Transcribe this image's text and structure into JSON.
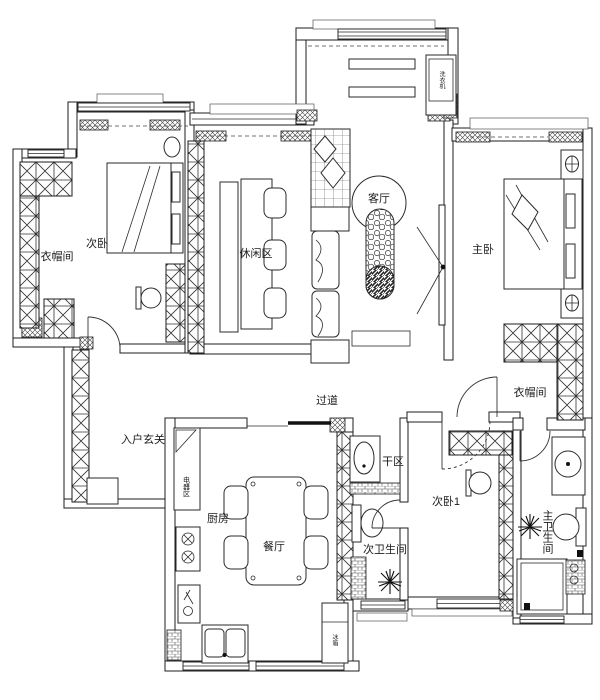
{
  "page": {
    "background": "#ffffff",
    "line_color": "#1c1c1c"
  },
  "rooms": {
    "cloakroom_left": {
      "label": "衣帽间"
    },
    "bedroom_2": {
      "label": "次卧"
    },
    "leisure_area": {
      "label": "休闲区"
    },
    "living_room": {
      "label": "客厅"
    },
    "master_bedroom": {
      "label": "主卧"
    },
    "cloakroom_right": {
      "label": "衣帽间"
    },
    "hallway": {
      "label": "过道"
    },
    "entry_foyer": {
      "label": "入户玄关"
    },
    "appliance_zone": {
      "label": "电器区"
    },
    "kitchen": {
      "label": "厨房"
    },
    "dining_room": {
      "label": "餐厅"
    },
    "dry_area": {
      "label": "干区"
    },
    "guest_bathroom": {
      "label": "次卫生间"
    },
    "bedroom_1": {
      "label": "次卧1"
    },
    "master_bathroom": {
      "label": "主卫生间"
    }
  },
  "appliances": {
    "washing_machine": {
      "label": "洗衣机"
    },
    "refrigerator": {
      "label": "冰箱"
    }
  }
}
